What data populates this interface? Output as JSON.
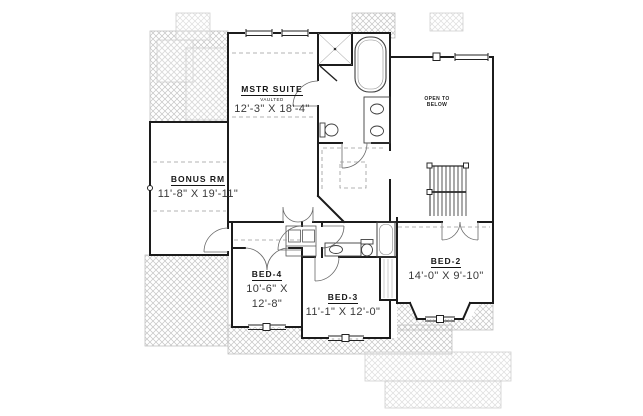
{
  "drawing": {
    "kind": "second floor plan",
    "colors": {
      "background": "#ffffff",
      "walls": "#1c1c1c",
      "hatch": "#c4c4c4",
      "hatch_light": "#dddddd",
      "room_name_text": "#161616",
      "dims_text": "#3a3a3a"
    },
    "rooms": {
      "mstr_suite": {
        "name": "MSTR SUITE",
        "note": "VAULTED",
        "dims": "12'-3\" X 18'-4\""
      },
      "bonus_rm": {
        "name": "BONUS RM",
        "dims": "11'-8\" X 19'-11\""
      },
      "bed_4": {
        "name": "BED-4",
        "dims_line1": "10'-6\" X",
        "dims_line2": "12'-8\""
      },
      "bed_3": {
        "name": "BED-3",
        "dims": "11'-1\" X 12'-0\""
      },
      "bed_2": {
        "name": "BED-2",
        "dims": "14'-0\" X 9'-10\""
      },
      "open_to_below": {
        "line1": "OPEN TO",
        "line2": "BELOW"
      }
    },
    "fixtures": [
      "shower",
      "soaking-tub",
      "double-vanity",
      "toilet",
      "walk-in-closet",
      "hall-bath-tub",
      "hall-bath-vanity",
      "laundry-appliances",
      "linen-shelves",
      "stairs",
      "bay-window"
    ]
  }
}
